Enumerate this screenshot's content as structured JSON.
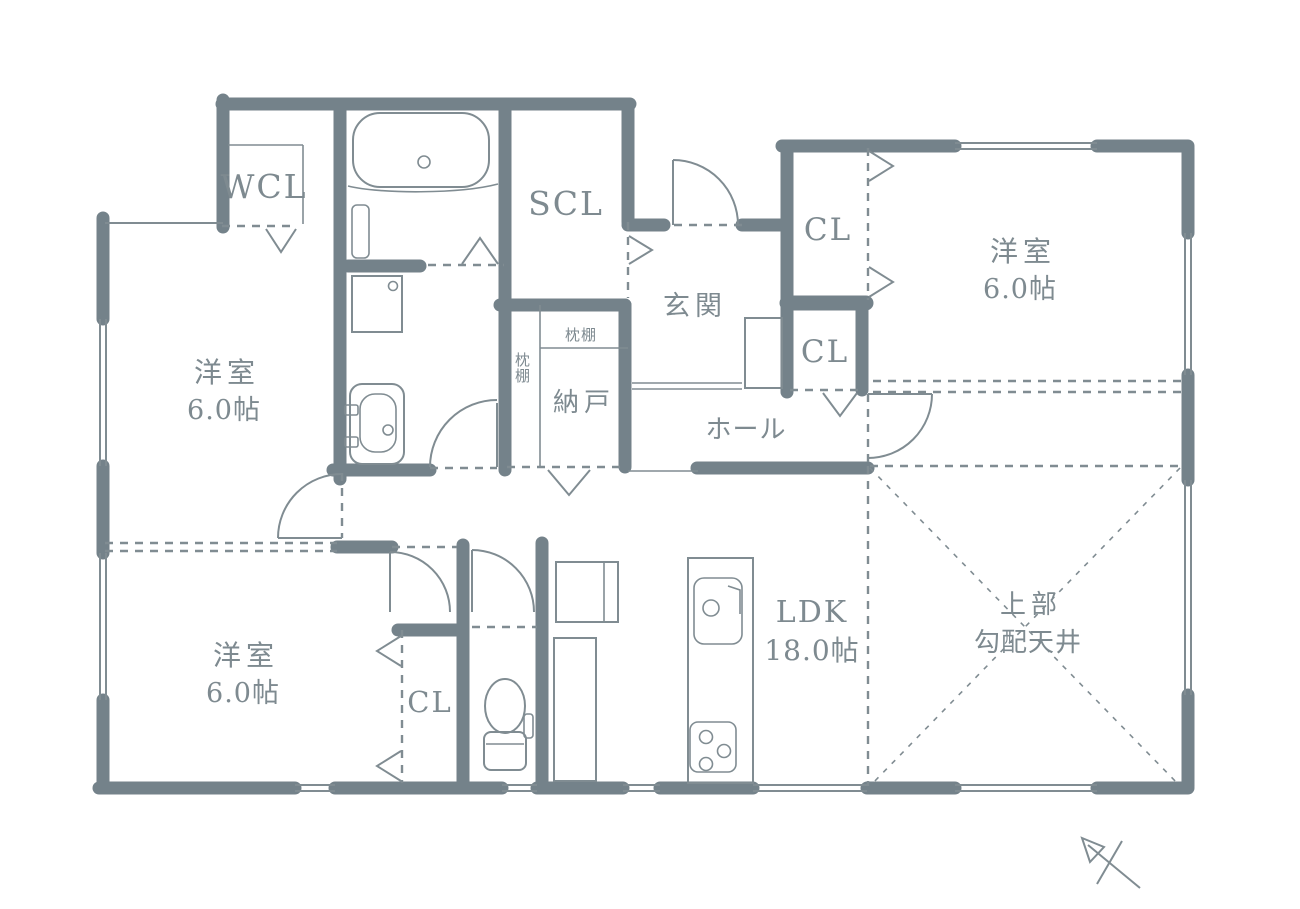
{
  "plan": {
    "type": "floor-plan",
    "rooms": {
      "wcl": {
        "label": "WCL"
      },
      "scl": {
        "label": "SCL"
      },
      "entrance": {
        "label": "玄関"
      },
      "hall": {
        "label": "ホール"
      },
      "storage_room": {
        "label": "納戸"
      },
      "pillow_shelf_top": {
        "label": "枕棚"
      },
      "pillow_shelf_side": {
        "label": "枕棚"
      },
      "closet_right_upper": {
        "label": "CL"
      },
      "closet_right_lower": {
        "label": "CL"
      },
      "closet_bottom_left": {
        "label": "CL"
      },
      "bedroom_top_right": {
        "name": "洋室",
        "area": "6.0帖"
      },
      "bedroom_left": {
        "name": "洋室",
        "area": "6.0帖"
      },
      "bedroom_bottom_left": {
        "name": "洋室",
        "area": "6.0帖"
      },
      "ldk": {
        "name": "LDK",
        "area": "18.0帖"
      },
      "sloped_ceiling": {
        "line1": "上部",
        "line2": "勾配天井"
      }
    },
    "icons": [
      "bathtub-icon",
      "bath-folding-door-icon",
      "washing-machine-icon",
      "washbasin-icon",
      "toilet-icon",
      "refrigerator-icon",
      "cupboard-icon",
      "kitchen-island-icon",
      "kitchen-sink-icon",
      "gas-stove-icon",
      "shoe-cabinet-icon",
      "door-swing-icon",
      "folding-door-triangle-icon",
      "window-icon",
      "north-arrow-icon"
    ],
    "colors": {
      "wall": "#74828A",
      "line": "#808C92",
      "text": "#7E8A90",
      "background": "#FFFFFF"
    }
  }
}
